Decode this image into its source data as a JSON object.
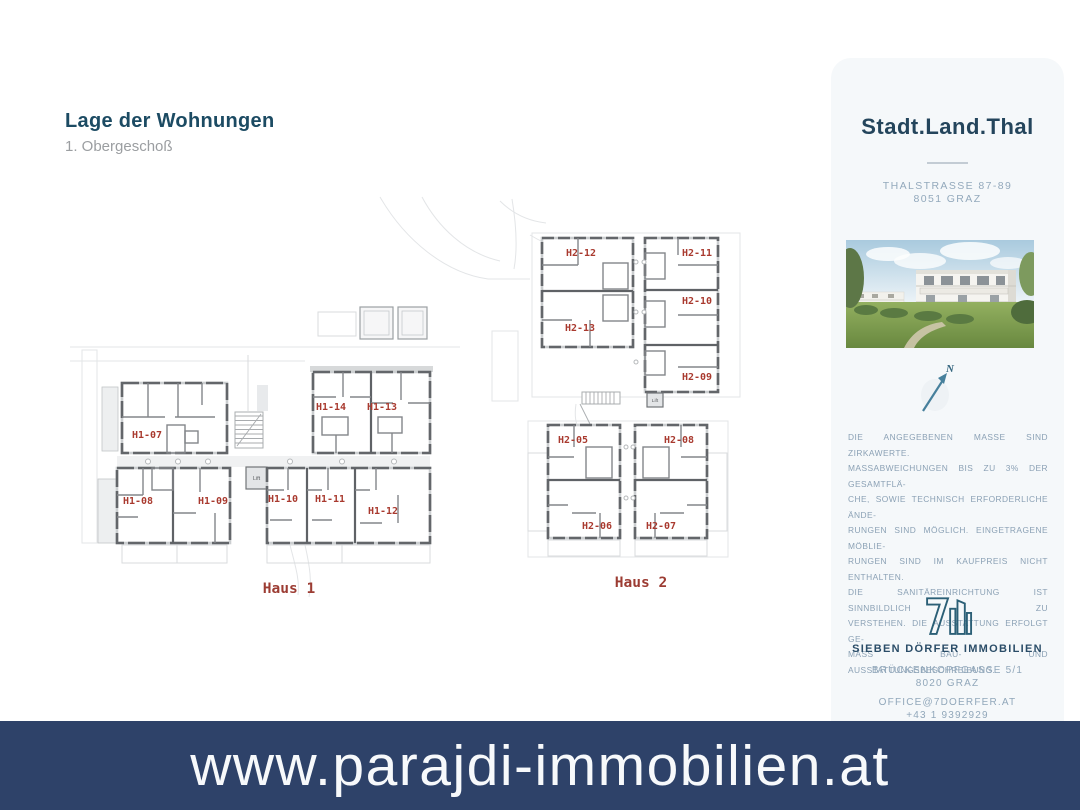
{
  "header": {
    "title": "Lage der Wohnungen",
    "subtitle": "1. Obergeschoß"
  },
  "floorplan": {
    "unit_label_color": "#a93a2f",
    "compass_label": "N",
    "haus1": {
      "label": "Haus 1",
      "lift": "Lift",
      "units": [
        "H1-07",
        "H1-14",
        "H1-13",
        "H1-08",
        "H1-09",
        "H1-10",
        "H1-11",
        "H1-12"
      ]
    },
    "haus2": {
      "label": "Haus 2",
      "lift": "Lift",
      "units": [
        "H2-12",
        "H2-11",
        "H2-13",
        "H2-10",
        "H2-09",
        "H2-05",
        "H2-08",
        "H2-06",
        "H2-07"
      ]
    }
  },
  "sidebar": {
    "project_title": "Stadt.Land.Thal",
    "address_line1": "THALSTRASSE 87-89",
    "address_line2": "8051 GRAZ",
    "disclaimer_lines": [
      "DIE ANGEGEBENEN MASSE SIND ZIRKAWERTE.",
      "MASSABWEICHUNGEN BIS ZU 3% DER GESAMTFLÄ-",
      "CHE, SOWIE TECHNISCH ERFORDERLICHE ÄNDE-",
      "RUNGEN SIND MÖGLICH. EINGETRAGENE MÖBLIE-",
      "RUNGEN SIND IM KAUFPREIS NICHT ENTHALTEN.",
      "DIE SANITÄREINRICHTUNG IST SINNBILDLICH ZU",
      "VERSTEHEN. DIE AUSSTATTUNG ERFOLGT GE-",
      "MÄSS BAU- UND AUSSTATTUNGSBESCHREIBUNG."
    ],
    "company": {
      "name": "SIEBEN DÖRFER IMMOBILIEN",
      "street": "BRÜCKENKOPFGASSE 5/1",
      "city": "8020 GRAZ",
      "email": "OFFICE@7DOERFER.AT",
      "phone": "+43 1 9392929"
    }
  },
  "banner": {
    "url_text": "www.parajdi-immobilien.at",
    "background": "#2e4269"
  }
}
